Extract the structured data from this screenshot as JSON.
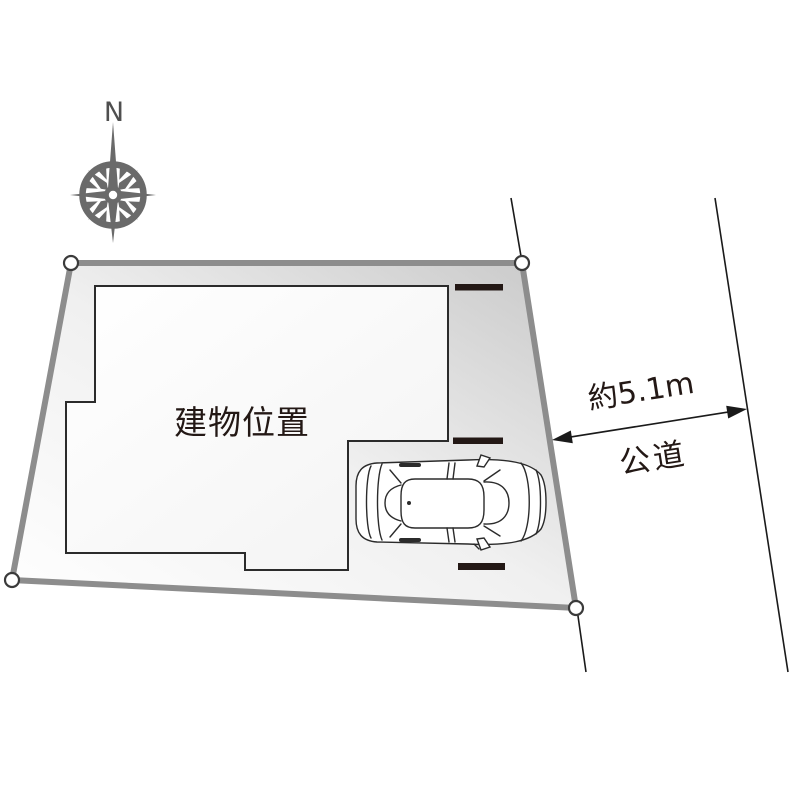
{
  "compass": {
    "north_label": "N"
  },
  "site_plan": {
    "building_label": "建物位置",
    "road_dimension_label": "約5.1m",
    "road_name_label": "公道"
  },
  "colors": {
    "parcel_border": "#8d8d8d",
    "parcel_fill_light": "#ffffff",
    "parcel_fill_dark": "#c8c8c8",
    "building_outline": "#2b2b2b",
    "building_fill": "#ffffff",
    "setback_dash": "#231815",
    "road_line": "#1a1a1a",
    "corner_marker_stroke": "#3b3b3b",
    "compass": "#6a6a6a",
    "text": "#231815",
    "north_text": "#4f4f4f"
  }
}
